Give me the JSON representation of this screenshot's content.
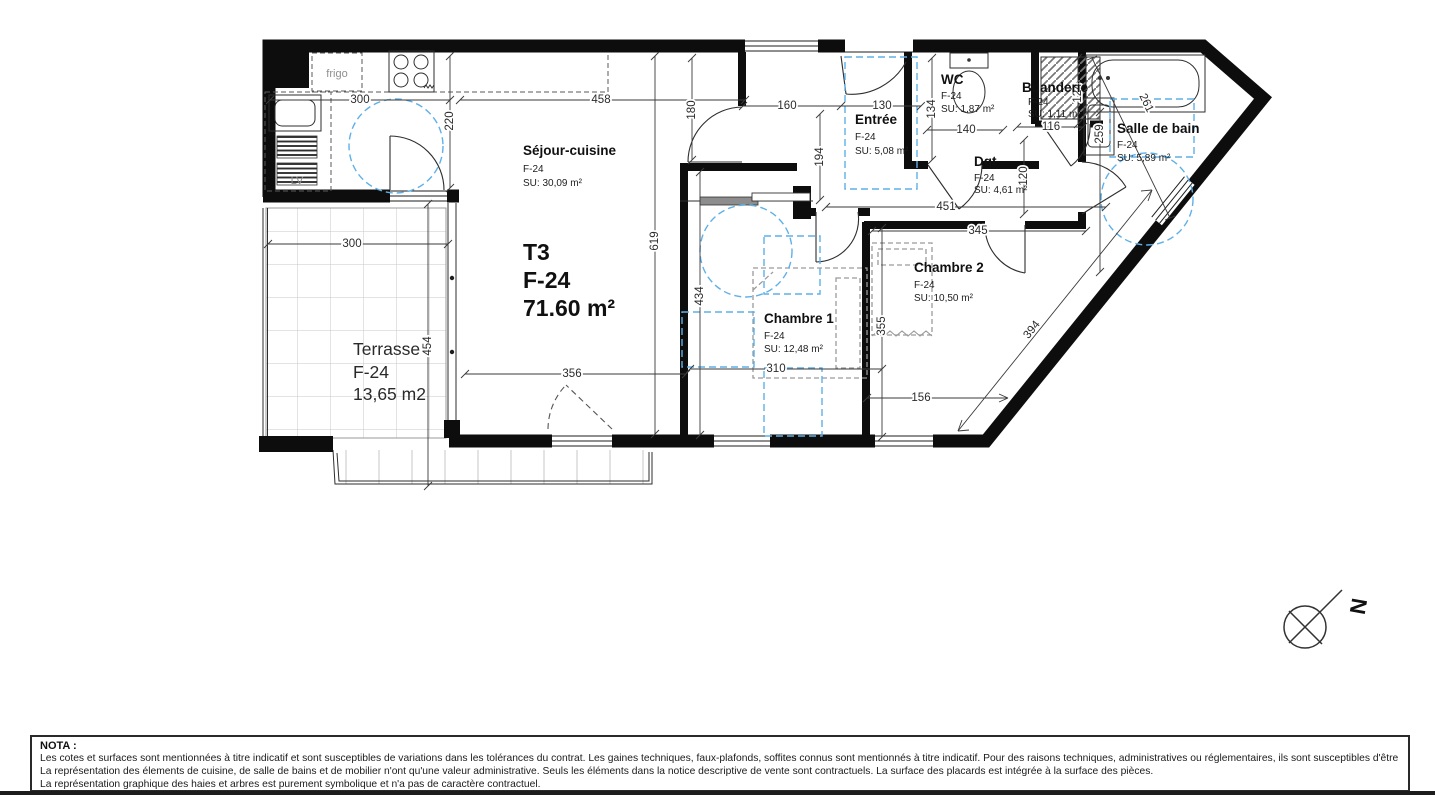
{
  "colors": {
    "wall": "#0d0d0d",
    "accessibility_blue": "#5fb0e8",
    "furniture_gray": "#9a9a9a"
  },
  "plan": {
    "unit": {
      "type": "T3",
      "lot": "F-24",
      "area": "71.60 m²"
    },
    "rooms": {
      "sejour": {
        "name": "Séjour-cuisine",
        "lot": "F-24",
        "surface": "SU: 30,09 m²"
      },
      "entree": {
        "name": "Entrée",
        "lot": "F-24",
        "surface": "SU: 5,08 m²"
      },
      "wc": {
        "name": "WC",
        "lot": "F-24",
        "surface": "SU: 1,87 m²"
      },
      "buanderie": {
        "name": "Buanderie",
        "lot": "F-24",
        "surface": "SU: 1,11 m²"
      },
      "sdb": {
        "name": "Salle de bain",
        "lot": "F-24",
        "surface": "SU: 5,89 m²"
      },
      "dgt": {
        "name": "Dgt",
        "lot": "F-24",
        "surface": "SU: 4,61 m²"
      },
      "ch1": {
        "name": "Chambre 1",
        "lot": "F-24",
        "surface": "SU: 12,48 m²"
      },
      "ch2": {
        "name": "Chambre 2",
        "lot": "F-24",
        "surface": "SU: 10,50 m²"
      },
      "terrasse": {
        "name": "Terrasse",
        "lot": "F-24",
        "surface": "13,65 m2"
      }
    },
    "labels": {
      "fridge": "frigo",
      "dishwasher": "LV",
      "north": "N"
    },
    "dims": {
      "d300k": "300",
      "d458": "458",
      "d180": "180",
      "d160": "160",
      "d130": "130",
      "d194": "194",
      "d134": "134",
      "d140": "140",
      "d116": "116",
      "d124": "124",
      "d259": "259",
      "d261": "261",
      "d220": "220",
      "d619": "619",
      "d434": "434",
      "d451": "451",
      "d345": "345",
      "d355": "355",
      "d310": "310",
      "d156": "156",
      "d394": "394",
      "d120": "120",
      "d300t": "300",
      "d454": "454",
      "d356": "356"
    }
  },
  "nota": {
    "title": "NOTA :",
    "lines": [
      "Les cotes et surfaces sont mentionnées à titre indicatif et sont susceptibles de variations dans les tolérances du contrat. Les gaines techniques, faux-plafonds, soffites connus sont mentionnés à titre indicatif. Pour des raisons techniques, administratives ou réglementaires, ils sont susceptibles d'être modifiés.",
      "La représentation des élements de cuisine, de salle de bains et de mobilier n'ont qu'une valeur administrative. Seuls les éléments dans la notice descriptive de vente sont contractuels. La surface des placards est intégrée à la surface des pièces.",
      "La représentation graphique des haies et arbres est purement symbolique et n'a pas de caractère contractuel."
    ]
  }
}
